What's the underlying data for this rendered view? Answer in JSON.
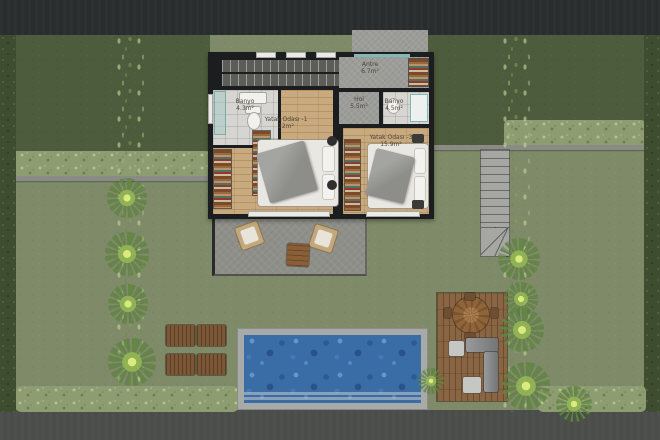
{
  "rooms": [
    {
      "name": "Banyo",
      "area": "4.3m²"
    },
    {
      "name": "Yatak Odası -1",
      "area": "22m²"
    },
    {
      "name": "Antre",
      "area": "6.7m²"
    },
    {
      "name": "Hol",
      "area": "5.5m²"
    },
    {
      "name": "Banyo",
      "area": "4.5m²"
    },
    {
      "name": "Yatak Odası -3",
      "area": "15.9m²"
    },
    {
      "name": "Teras",
      "area": "21 m²"
    }
  ],
  "colors": {
    "road_top": "#2a2d2e",
    "road_bottom": "#4b4d4a",
    "front_lawn": "#4d5c3c",
    "garden_lawn": "#7e8a68",
    "hedge": "#8e9c72",
    "boundary_hedge": "#3e4c30",
    "pool_water": "#3a6ca6",
    "pool_edge": "#a7aaa6",
    "wood_floor": "#c9a97e",
    "wood_deck": "#8a6544",
    "walls": "#1c1d1f",
    "concrete": "#9c9c98",
    "glass_door": "#7fb8b4"
  }
}
